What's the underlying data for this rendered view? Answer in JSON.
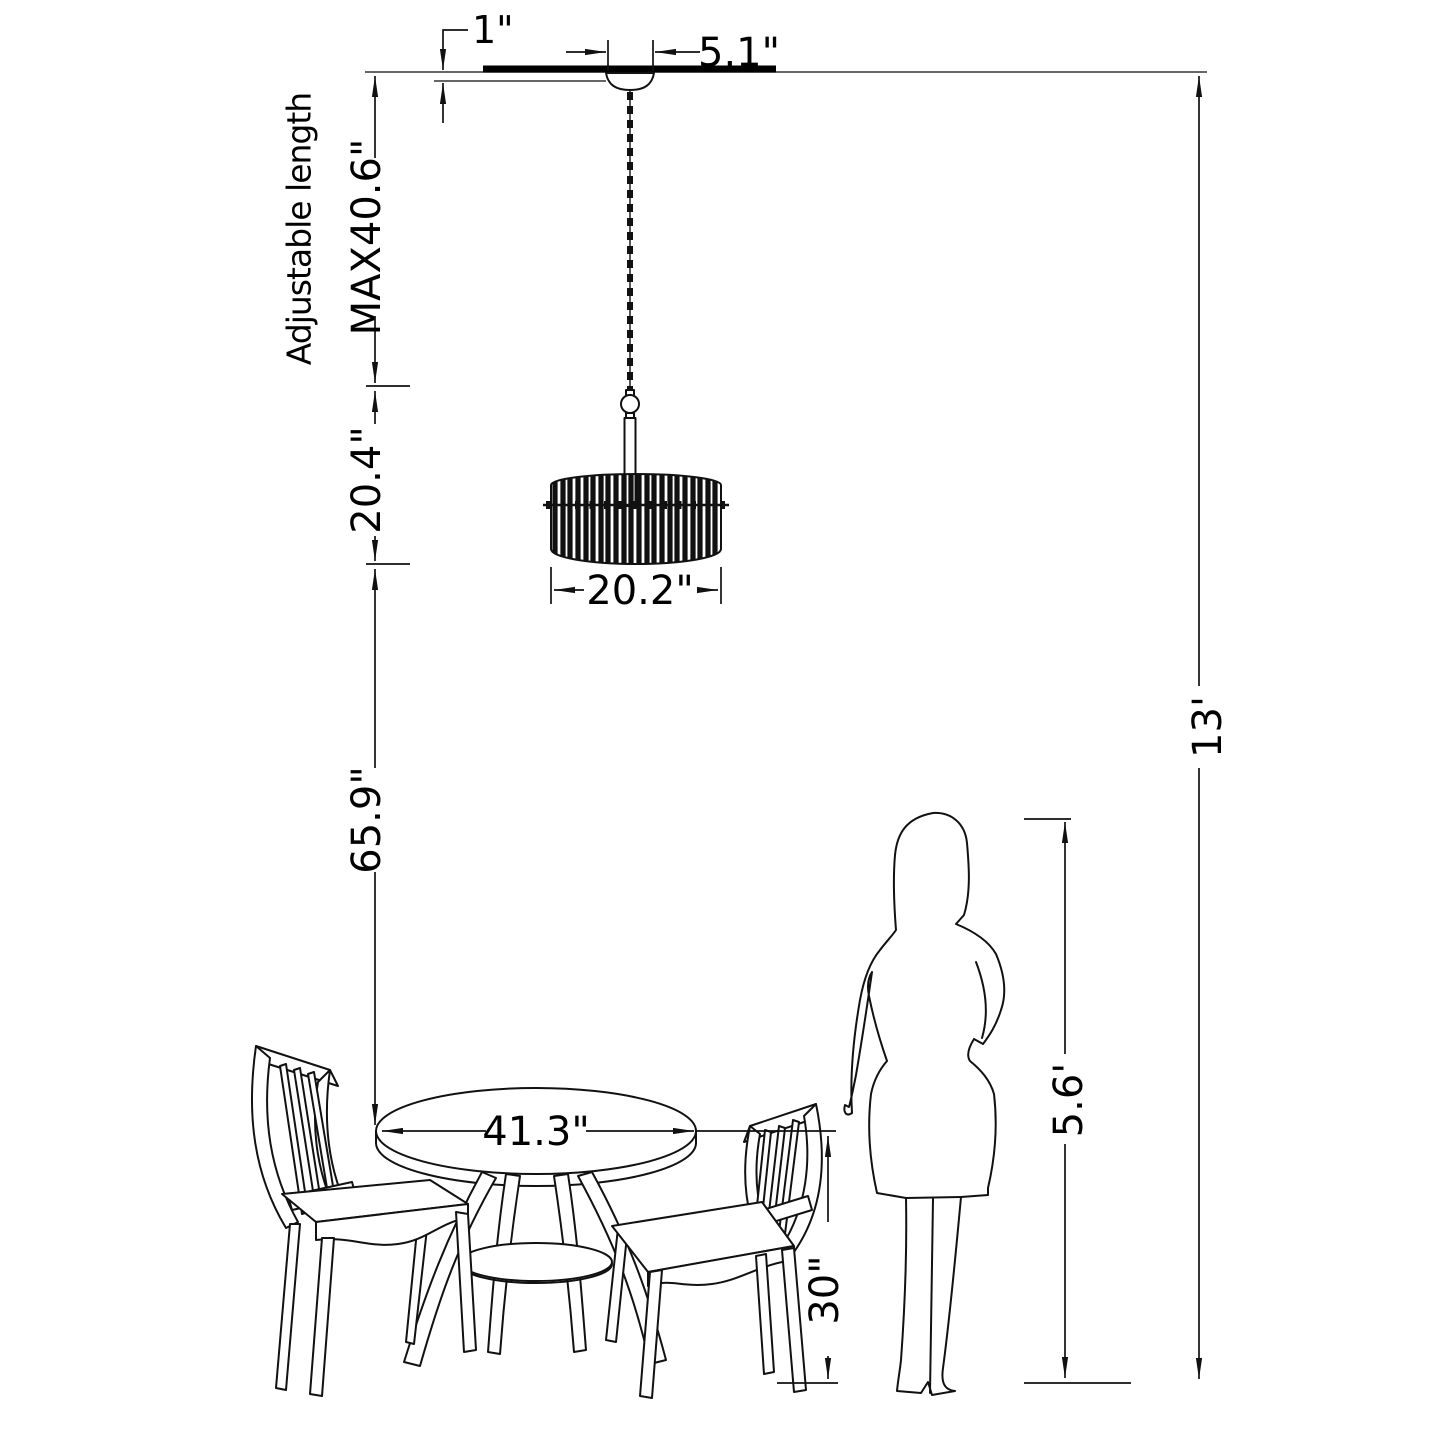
{
  "diagram": {
    "kind": "chandelier installation dimension drawing",
    "background_color": "#ffffff",
    "line_color": "#111111",
    "objects": [
      "ceiling-line",
      "mounting-plate",
      "canopy",
      "hanging-chain",
      "drum-chandelier",
      "round-dining-table",
      "side-chair-left",
      "side-chair-right",
      "woman-silhouette",
      "floor-marks"
    ]
  },
  "dimensions": {
    "plate_thickness": "1\"",
    "canopy_width": "5.1\"",
    "adjustable_note": "Adjustable length",
    "max_hanging_length": "MAX40.6\"",
    "fixture_height": "20.4\"",
    "fixture_diameter": "20.2\"",
    "fixture_to_table": "65.9\"",
    "ceiling_height": "13'",
    "table_diameter": "41.3\"",
    "table_height": "30\"",
    "person_height": "5.6'"
  }
}
